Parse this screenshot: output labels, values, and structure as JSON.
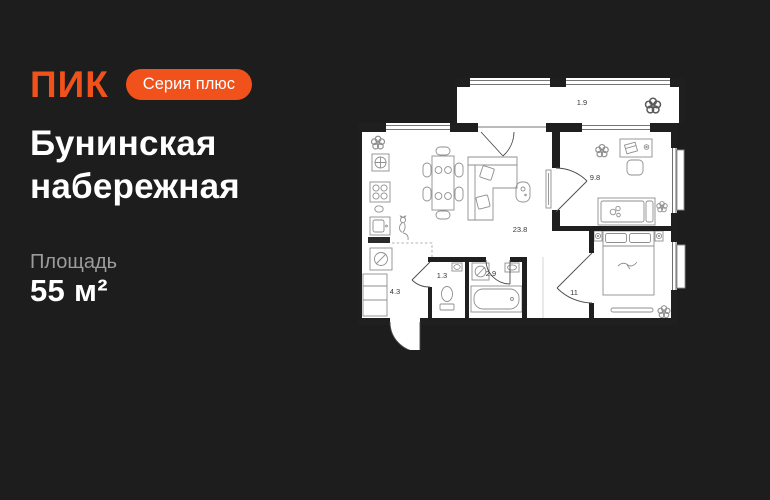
{
  "theme": {
    "background": "#1d1d1d",
    "accent": "#f1511b",
    "muted_text": "#9c9c9c",
    "wall_color": "#1f1f1f",
    "furniture_line": "#8f8f8f",
    "plan_bg": "#ffffff",
    "label_color": "#383838"
  },
  "header": {
    "logo": "ПИК",
    "badge": "Серия плюс"
  },
  "title": "Бунинская набережная",
  "area": {
    "label": "Площадь",
    "value": "55 м²"
  },
  "floorplan": {
    "rooms": [
      {
        "name": "balcony",
        "area": "1.9"
      },
      {
        "name": "study",
        "area": "9.8"
      },
      {
        "name": "living",
        "area": "23.8"
      },
      {
        "name": "bedroom",
        "area": "11"
      },
      {
        "name": "wc",
        "area": "1.3"
      },
      {
        "name": "bathroom",
        "area": "2.9"
      },
      {
        "name": "hallway",
        "area": "4.3"
      }
    ]
  }
}
